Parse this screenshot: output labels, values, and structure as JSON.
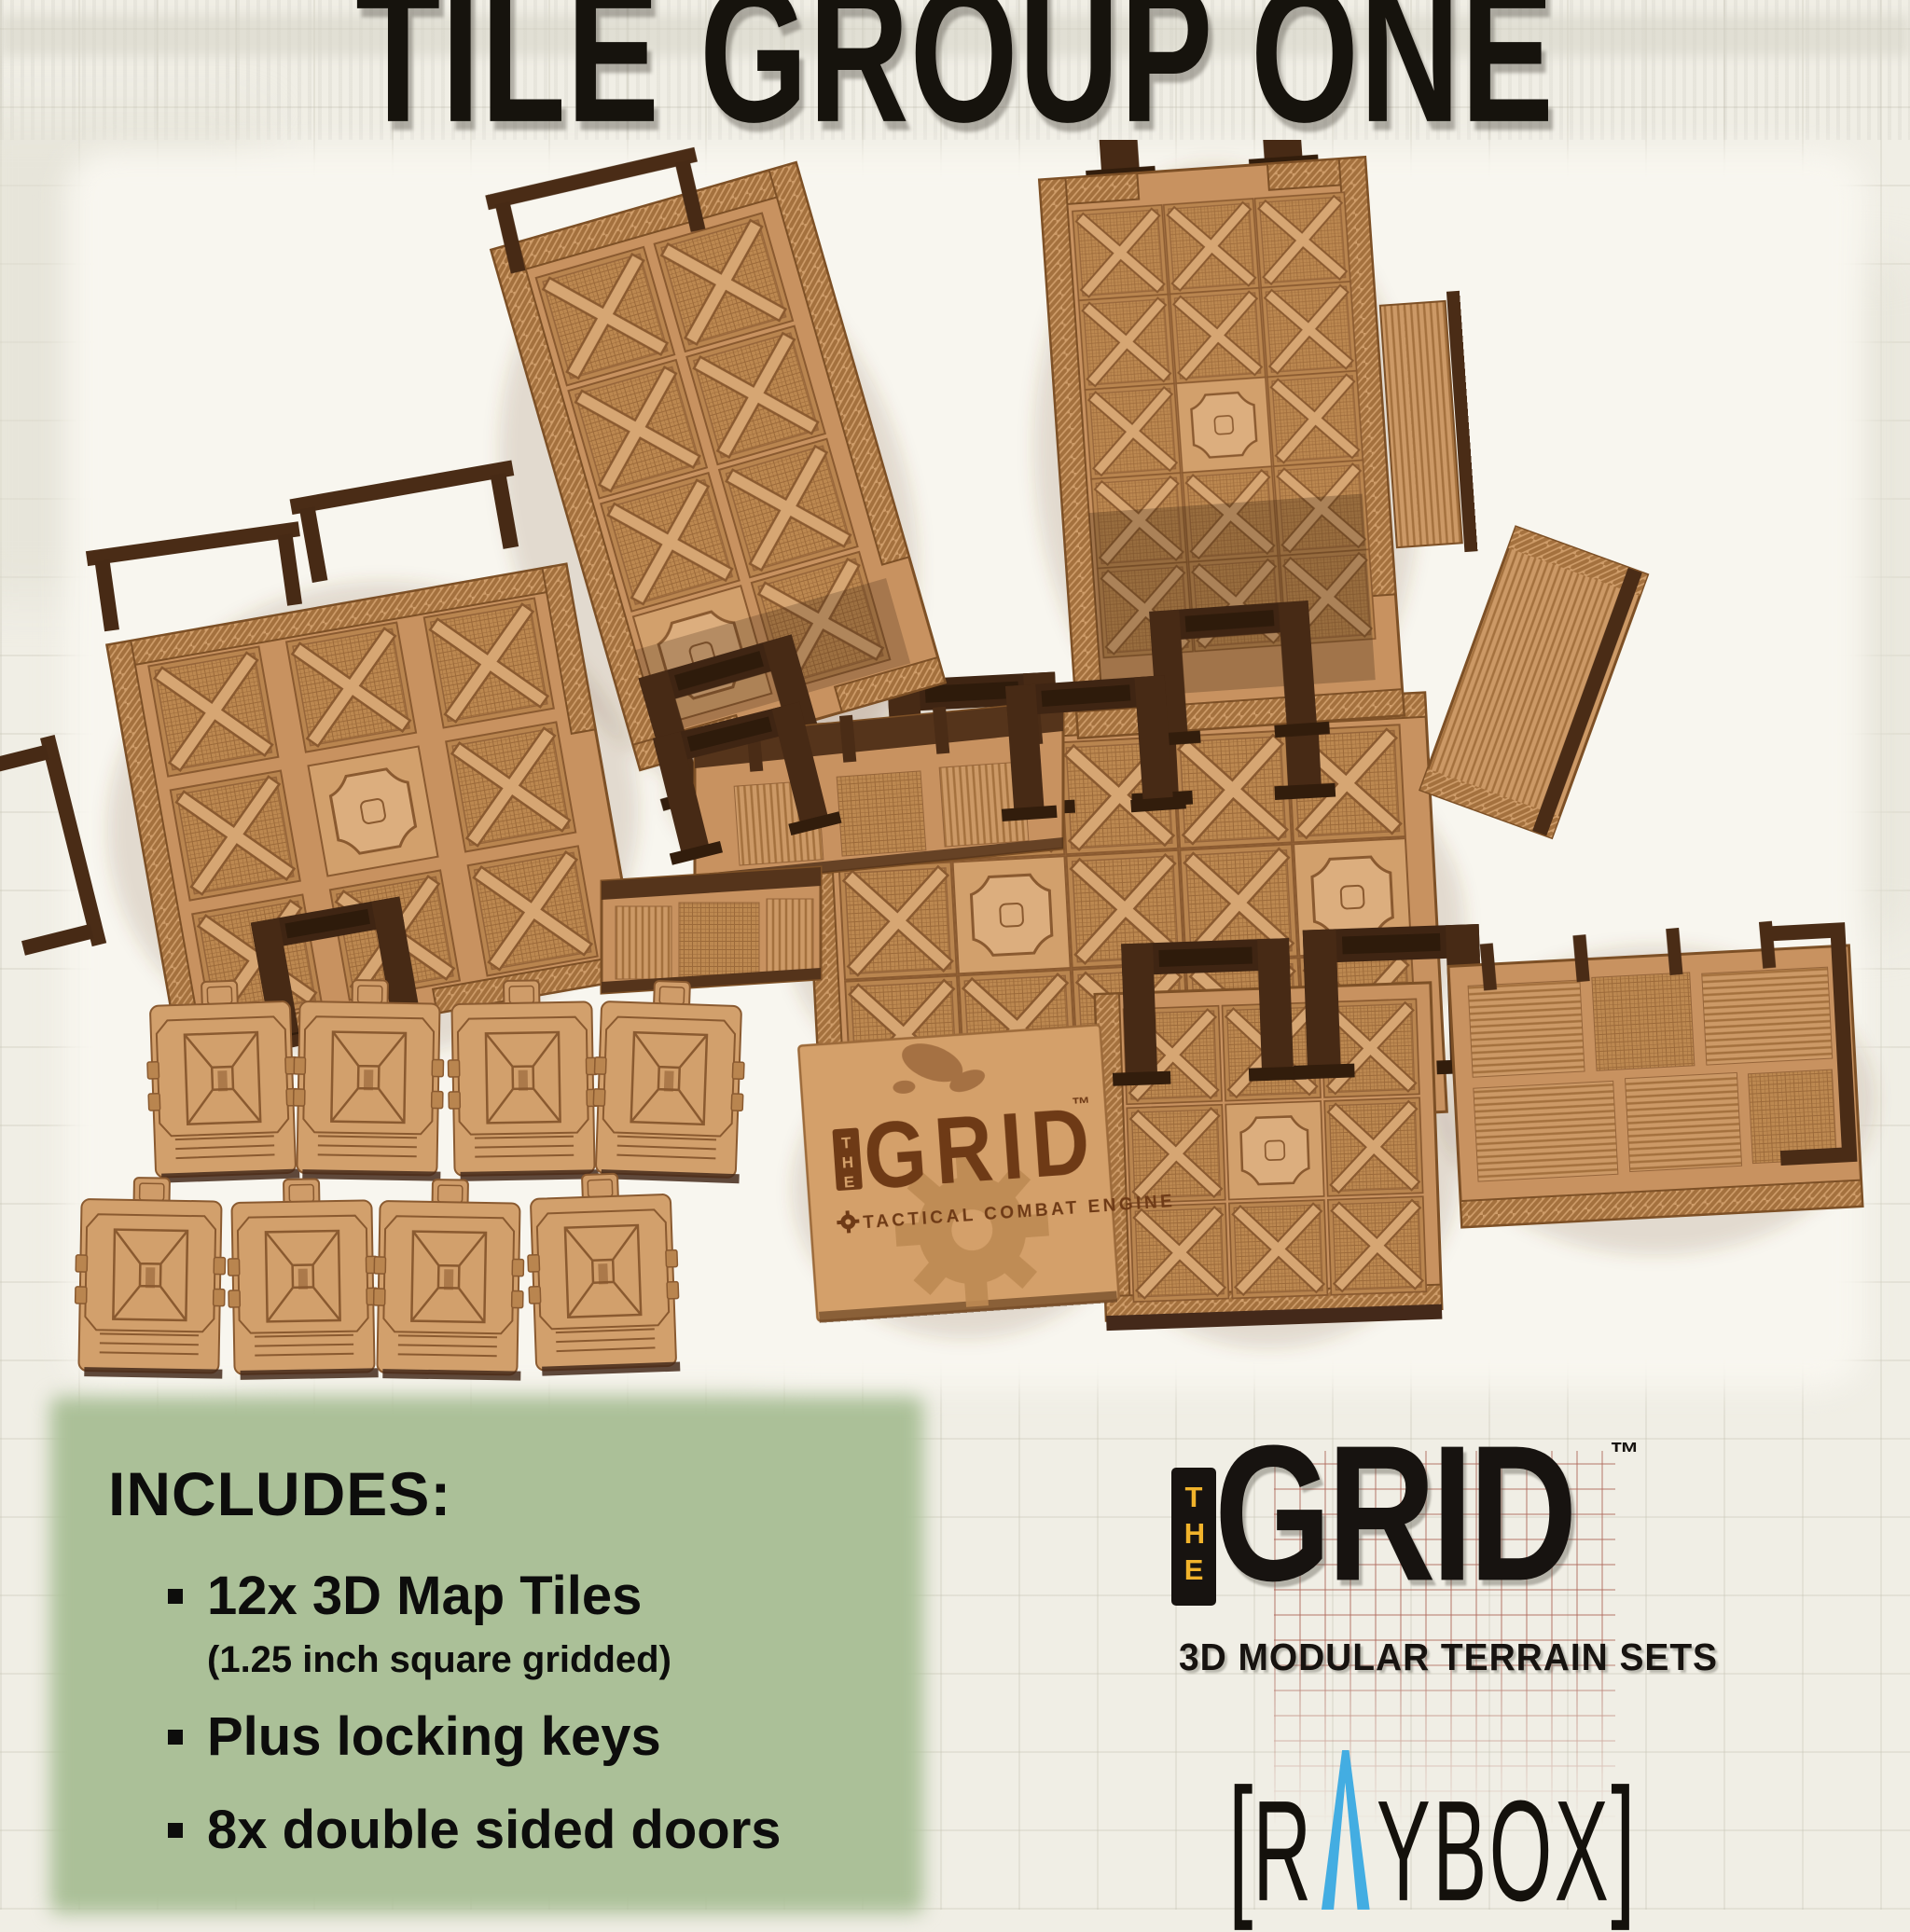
{
  "page": {
    "background_color": "#f0eee5",
    "photo_background_color": "#f8f6ef",
    "grid_line_color": "#c6c3b3"
  },
  "title": {
    "text": "TILE GROUP ONE",
    "color": "#16130d"
  },
  "includes_panel": {
    "bg_color": "#abc098",
    "heading": "INCLUDES:",
    "bullets": [
      {
        "text": "12x 3D Map Tiles",
        "subtext": "(1.25 inch square gridded)"
      },
      {
        "text": "Plus locking keys"
      },
      {
        "text": "8x double sided doors"
      }
    ]
  },
  "grid_logo": {
    "the_vertical": "THE",
    "name": "GRID",
    "trademark": "™",
    "tagline": "3D MODULAR TERRAIN SETS",
    "the_color": "#f1b32b",
    "ink_color": "#171310",
    "backdrop_grid_color": "#ad675a"
  },
  "raybox_logo": {
    "left_bracket": "[",
    "letter_r": "R",
    "letters_rest": "YBOX",
    "right_bracket": "]",
    "a_triangle_color": "#43ade2",
    "ink_color": "#14110c"
  },
  "branded_tile": {
    "the_vertical": "THE",
    "name": "GRID",
    "trademark": "™",
    "tagline": "TACTICAL COMBAT ENGINE",
    "engrave_color": "#6e3a16"
  },
  "photo": {
    "doors_visible_count": 8,
    "mdf_light": "#dcae7e",
    "mdf_mid": "#cd9a68",
    "mdf_dark": "#b9854f",
    "engrave_color": "#8a5a30",
    "dark_frame_color": "#3f2513",
    "wall_top_color": "#4a2c16"
  }
}
